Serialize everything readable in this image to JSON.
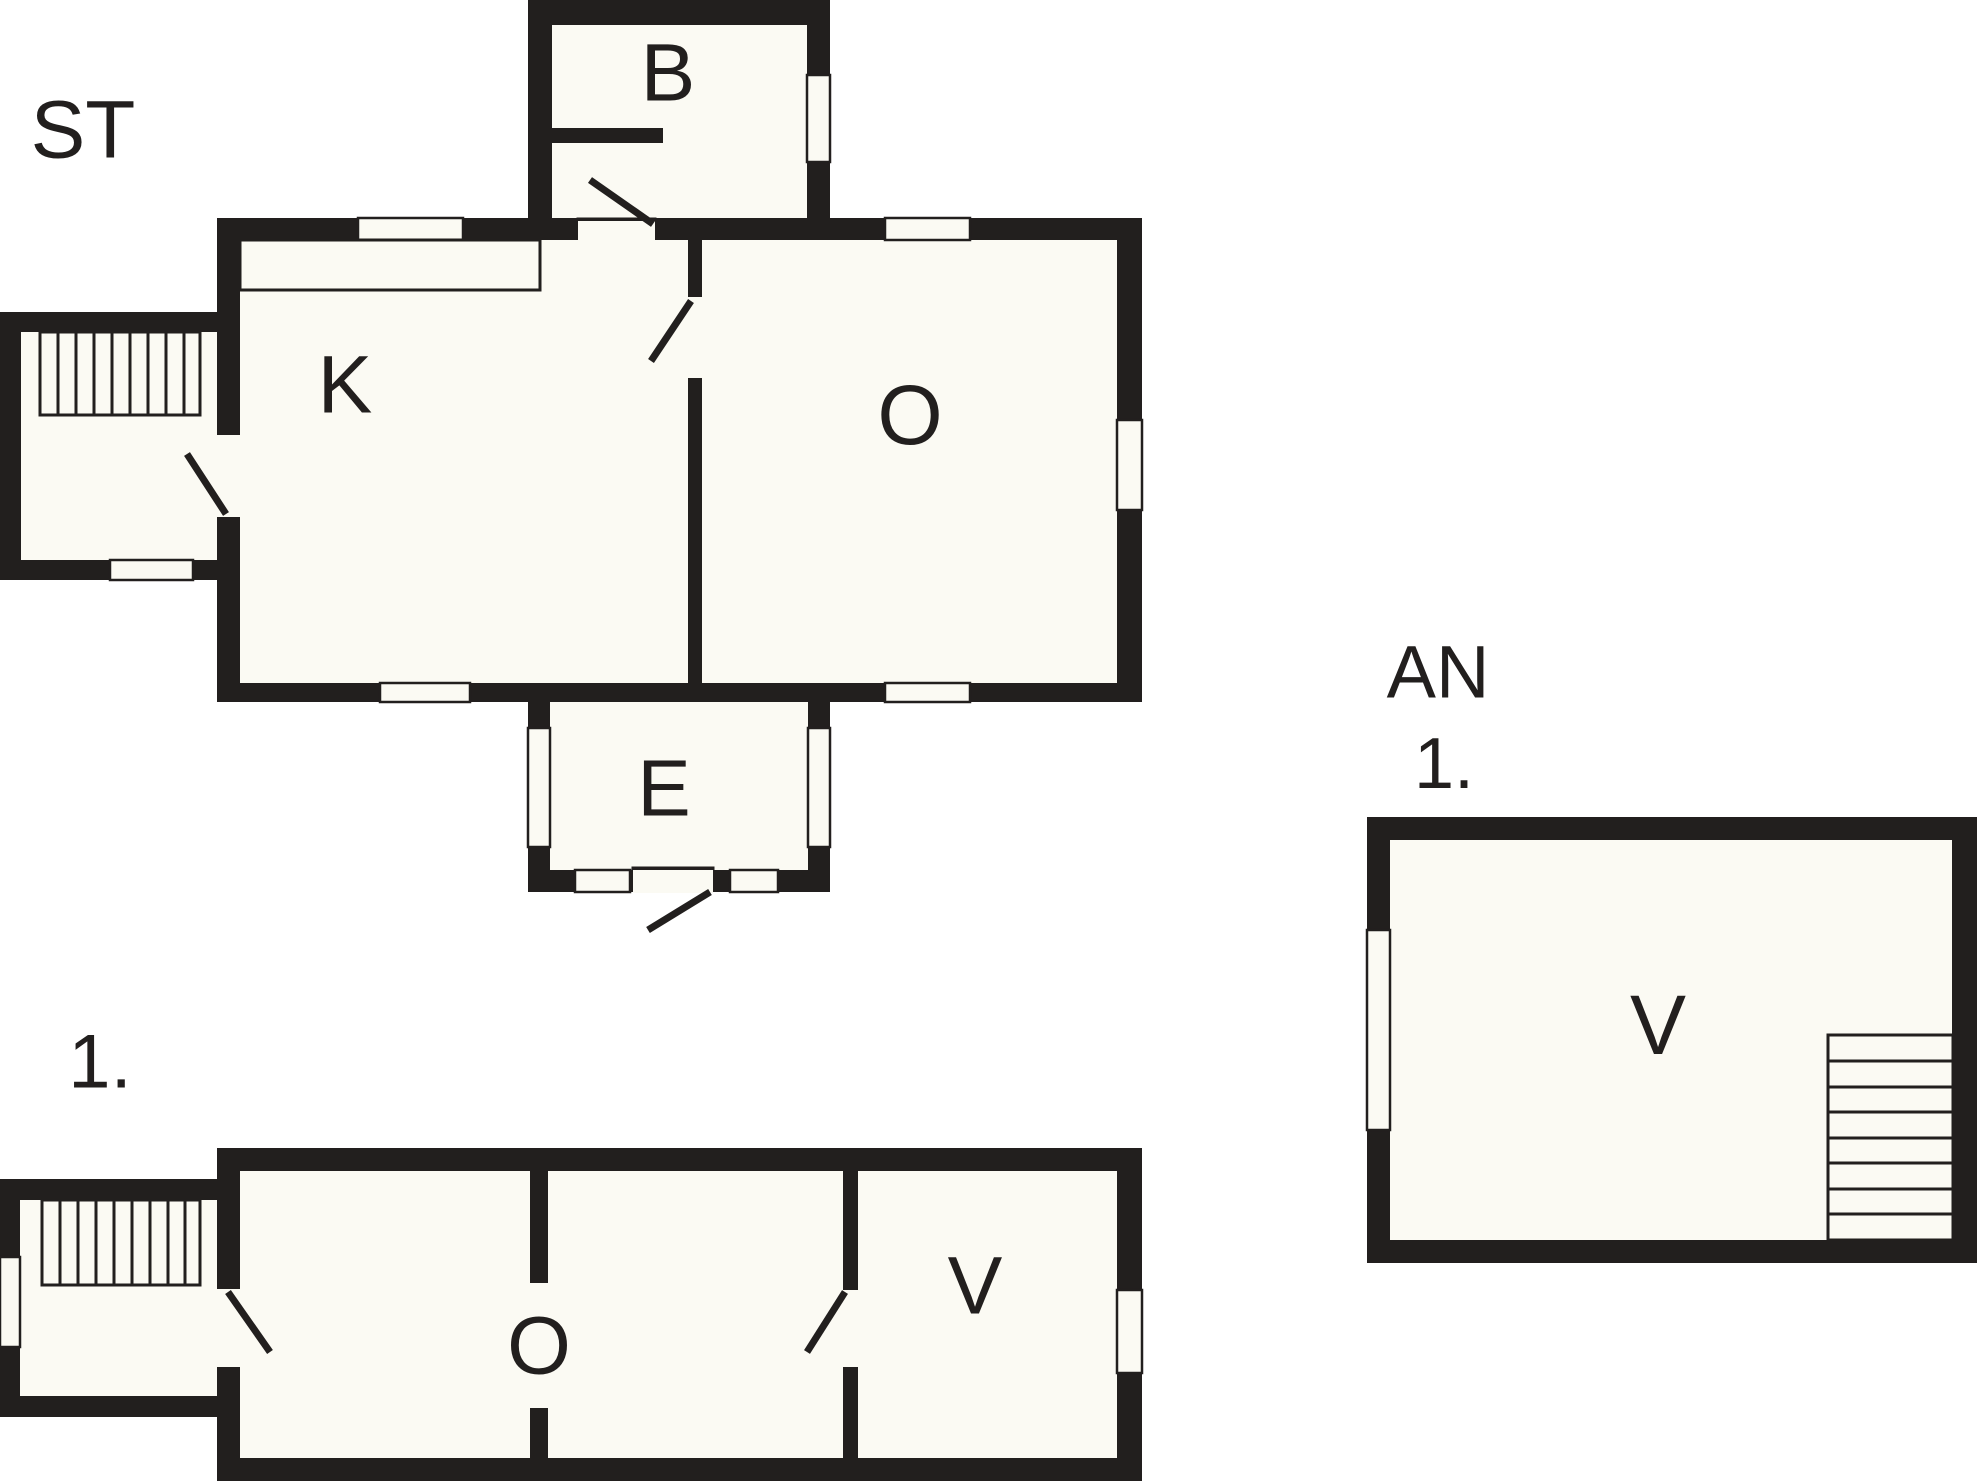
{
  "title": "Floor plan drawing",
  "colors": {
    "background": "#ffffff",
    "wall": "#221f1e",
    "floor_fill": "#fbfaf3"
  },
  "plans": {
    "st": {
      "title": "ST",
      "rooms": {
        "b": "B",
        "k": "K",
        "o": "O",
        "e": "E"
      }
    },
    "first": {
      "title": "1.",
      "rooms": {
        "o": "O",
        "v": "V"
      }
    },
    "annex": {
      "title": "AN",
      "subtitle": "1.",
      "rooms": {
        "v": "V"
      }
    }
  }
}
